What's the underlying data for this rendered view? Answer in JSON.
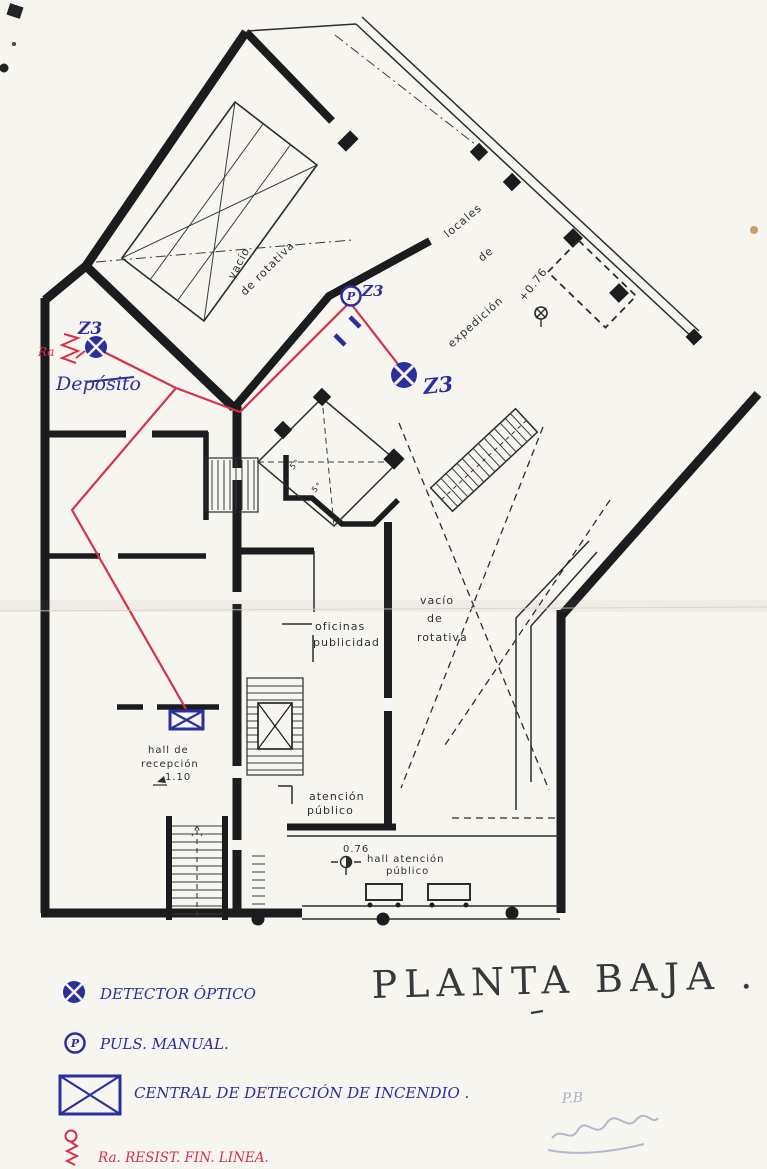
{
  "title": "PLANTA BAJA .",
  "plan": {
    "labels": {
      "vacio_top_1": "vacío",
      "vacio_top_2": "de rotativa",
      "locales_1": "locales",
      "locales_2": "de",
      "locales_3": "expedición",
      "level_top": "+0.76",
      "oficinas_1": "oficinas",
      "oficinas_2": "publicidad",
      "vacio_mid_1": "vacío",
      "vacio_mid_2": "de",
      "vacio_mid_3": "rotativa",
      "hall_recep_1": "hall de",
      "hall_recep_2": "recepción",
      "hall_recep_level": "1.10",
      "atencion_1": "atención",
      "atencion_2": "público",
      "hall_at_level": "0.76",
      "hall_at_1": "hall atención",
      "hall_at_2": "público",
      "room5_a": "5°",
      "room5_b": "5°"
    },
    "annotations": {
      "zone_det1": "Z3",
      "zone_puls": "Z3",
      "zone_det2": "Z3",
      "deposito": "Depósito",
      "ra": "Ra",
      "p_letter": "P"
    }
  },
  "legend": {
    "items": [
      {
        "symbol": "optical-detector",
        "label": "DETECTOR ÓPTICO"
      },
      {
        "symbol": "manual-pushbutton",
        "label": "PULS. MANUAL."
      },
      {
        "symbol": "fire-detection-panel",
        "label": "CENTRAL DE DETECCIÓN DE INCENDIO ."
      },
      {
        "symbol": "end-of-line-resistor",
        "label": "Ra. RESIST. FIN. LINEA."
      }
    ]
  },
  "pencil": {
    "note": "P.B"
  },
  "colors": {
    "ink_blue": "#2b2f9c",
    "wire_red": "#d6314b",
    "plan_black": "#1c1c1e",
    "paper": "#f7f5f0",
    "pencil_gray": "#98a0bd",
    "title_ink": "#37373c"
  }
}
